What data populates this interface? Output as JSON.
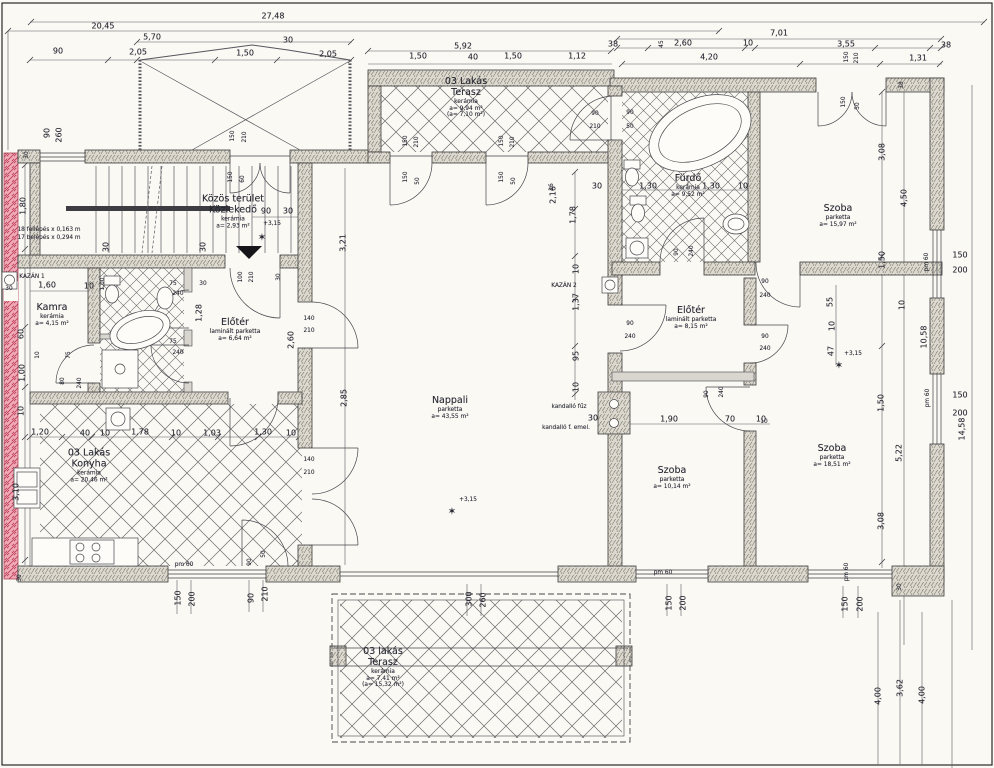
{
  "drawing": {
    "language": "Hungarian",
    "kind": "scanned floor plan",
    "level_mark": "+3,15"
  },
  "rooms": [
    {
      "id": "kozlekedo",
      "x": 233,
      "y": 212,
      "name": [
        "Közös terület",
        "Közlekedő"
      ],
      "sub": [
        "kerámia",
        "a= 2,93 m²"
      ]
    },
    {
      "id": "kamra",
      "x": 52,
      "y": 315,
      "name": [
        "Kamra"
      ],
      "sub": [
        "kerámia",
        "a= 4,15 m²"
      ]
    },
    {
      "id": "eloter-1",
      "x": 235,
      "y": 330,
      "name": [
        "Előtér"
      ],
      "sub": [
        "laminált parketta",
        "a= 6,64 m²"
      ]
    },
    {
      "id": "konyha",
      "x": 89,
      "y": 466,
      "name": [
        "03 Lakás",
        "Konyha"
      ],
      "sub": [
        "kerámia",
        "a= 20,46 m²"
      ]
    },
    {
      "id": "nappali",
      "x": 450,
      "y": 408,
      "name": [
        "Nappali"
      ],
      "sub": [
        "parketta",
        "a= 43,55 m²"
      ]
    },
    {
      "id": "terasz-felso",
      "x": 466,
      "y": 98,
      "name": [
        "03 Lakás",
        "Terasz"
      ],
      "sub": [
        "kerámia",
        "a= 9,94 m²",
        "(a= 7,10 m²)"
      ]
    },
    {
      "id": "furdo",
      "x": 688,
      "y": 186,
      "name": [
        "Fürdő"
      ],
      "sub": [
        "kerámia",
        "a= 9,52 m²"
      ]
    },
    {
      "id": "szoba-1",
      "x": 838,
      "y": 216,
      "name": [
        "Szoba"
      ],
      "sub": [
        "parketta",
        "a= 15,97 m²"
      ]
    },
    {
      "id": "eloter-2",
      "x": 691,
      "y": 318,
      "name": [
        "Előtér"
      ],
      "sub": [
        "laminált parketta",
        "a= 8,15 m²"
      ]
    },
    {
      "id": "szoba-2",
      "x": 672,
      "y": 478,
      "name": [
        "Szoba"
      ],
      "sub": [
        "parketta",
        "a= 10,14 m²"
      ]
    },
    {
      "id": "szoba-3",
      "x": 832,
      "y": 456,
      "name": [
        "Szoba"
      ],
      "sub": [
        "parketta",
        "a= 18,51 m²"
      ]
    },
    {
      "id": "terasz-also",
      "x": 383,
      "y": 668,
      "name": [
        "03 lakás",
        "Terasz"
      ],
      "sub": [
        "kerámia",
        "a= 7,41 m²",
        "(a= 15,32 m²)"
      ]
    }
  ],
  "labels": [
    {
      "t": "27,48",
      "x": 273,
      "y": 16
    },
    {
      "t": "20,45",
      "x": 103,
      "y": 26
    },
    {
      "t": "5,70",
      "x": 152,
      "y": 37
    },
    {
      "t": "2,05",
      "x": 138,
      "y": 52
    },
    {
      "t": "1,50",
      "x": 245,
      "y": 53
    },
    {
      "t": "30",
      "x": 288,
      "y": 40
    },
    {
      "t": "2,05",
      "x": 328,
      "y": 54
    },
    {
      "t": "90",
      "x": 58,
      "y": 51
    },
    {
      "t": "5,92",
      "x": 463,
      "y": 46
    },
    {
      "t": "1,50",
      "x": 418,
      "y": 56
    },
    {
      "t": "40",
      "x": 473,
      "y": 57
    },
    {
      "t": "1,50",
      "x": 513,
      "y": 56
    },
    {
      "t": "1,12",
      "x": 577,
      "y": 56
    },
    {
      "t": "7,01",
      "x": 779,
      "y": 33
    },
    {
      "t": "38",
      "x": 613,
      "y": 44
    },
    {
      "t": "45",
      "x": 662,
      "y": 44,
      "r": 1,
      "s": 2
    },
    {
      "t": "2,60",
      "x": 683,
      "y": 43
    },
    {
      "t": "10",
      "x": 748,
      "y": 43
    },
    {
      "t": "3,55",
      "x": 846,
      "y": 44
    },
    {
      "t": "38",
      "x": 946,
      "y": 45
    },
    {
      "t": "4,20",
      "x": 709,
      "y": 57
    },
    {
      "t": "150",
      "x": 847,
      "y": 57,
      "r": 1,
      "s": 2
    },
    {
      "t": "210",
      "x": 857,
      "y": 58,
      "r": 1,
      "s": 2
    },
    {
      "t": "1,31",
      "x": 918,
      "y": 58
    },
    {
      "t": "90",
      "x": 47,
      "y": 133,
      "r": 1
    },
    {
      "t": "260",
      "x": 59,
      "y": 135,
      "r": 1
    },
    {
      "t": "30",
      "x": 27,
      "y": 155,
      "r": 1,
      "s": 2
    },
    {
      "t": "150",
      "x": 233,
      "y": 136,
      "r": 1,
      "s": 2
    },
    {
      "t": "210",
      "x": 245,
      "y": 137,
      "r": 1,
      "s": 2
    },
    {
      "t": "1,80",
      "x": 23,
      "y": 206,
      "r": 1
    },
    {
      "t": "150",
      "x": 231,
      "y": 177,
      "r": 1,
      "s": 2
    },
    {
      "t": "60",
      "x": 243,
      "y": 179,
      "r": 1,
      "s": 2
    },
    {
      "t": "90",
      "x": 266,
      "y": 211
    },
    {
      "t": "30",
      "x": 288,
      "y": 211
    },
    {
      "t": "+3,15",
      "x": 272,
      "y": 224,
      "s": 2
    },
    {
      "t": "✶",
      "x": 262,
      "y": 238,
      "s": 6,
      "n": "level-marker-icon"
    },
    {
      "t": "3,21",
      "x": 343,
      "y": 243,
      "r": 1
    },
    {
      "t": "30",
      "x": 106,
      "y": 247,
      "r": 1
    },
    {
      "t": "30",
      "x": 203,
      "y": 247,
      "r": 1
    },
    {
      "t": "KAZÁN 1",
      "x": 32,
      "y": 277,
      "s": 2
    },
    {
      "t": "30",
      "x": 9,
      "y": 289,
      "s": 2
    },
    {
      "t": "1,60",
      "x": 47,
      "y": 285
    },
    {
      "t": "10",
      "x": 89,
      "y": 286
    },
    {
      "t": "100",
      "x": 241,
      "y": 277,
      "r": 1,
      "s": 2
    },
    {
      "t": "210",
      "x": 252,
      "y": 277,
      "r": 1,
      "s": 2
    },
    {
      "t": "30",
      "x": 279,
      "y": 277,
      "r": 1,
      "s": 2
    },
    {
      "t": "75",
      "x": 173,
      "y": 284,
      "s": 2
    },
    {
      "t": "240",
      "x": 178,
      "y": 294,
      "s": 2
    },
    {
      "t": "30",
      "x": 203,
      "y": 284,
      "s": 2
    },
    {
      "t": "1,00",
      "x": 103,
      "y": 284,
      "r": 1,
      "s": 2
    },
    {
      "t": "1,28",
      "x": 199,
      "y": 313,
      "r": 1
    },
    {
      "t": "60",
      "x": 21,
      "y": 334,
      "r": 1
    },
    {
      "t": "75",
      "x": 69,
      "y": 355,
      "r": 1,
      "s": 2
    },
    {
      "t": "10",
      "x": 38,
      "y": 355,
      "r": 1,
      "s": 2
    },
    {
      "t": "1,00",
      "x": 22,
      "y": 373,
      "r": 1
    },
    {
      "t": "80",
      "x": 63,
      "y": 381,
      "r": 1,
      "s": 2
    },
    {
      "t": "240",
      "x": 80,
      "y": 383,
      "r": 1,
      "s": 2
    },
    {
      "t": "75",
      "x": 173,
      "y": 342,
      "s": 2
    },
    {
      "t": "240",
      "x": 178,
      "y": 353,
      "s": 2
    },
    {
      "t": "10",
      "x": 21,
      "y": 411,
      "r": 1
    },
    {
      "t": "140",
      "x": 309,
      "y": 319,
      "s": 2
    },
    {
      "t": "210",
      "x": 309,
      "y": 331,
      "s": 2
    },
    {
      "t": "2,60",
      "x": 291,
      "y": 340,
      "r": 1
    },
    {
      "t": "2,85",
      "x": 344,
      "y": 398,
      "r": 1
    },
    {
      "t": "140",
      "x": 309,
      "y": 460,
      "s": 2
    },
    {
      "t": "210",
      "x": 309,
      "y": 473,
      "s": 2
    },
    {
      "t": "1,20",
      "x": 40,
      "y": 432
    },
    {
      "t": "40",
      "x": 85,
      "y": 433
    },
    {
      "t": "10",
      "x": 105,
      "y": 433
    },
    {
      "t": "1,78",
      "x": 140,
      "y": 432
    },
    {
      "t": "10",
      "x": 176,
      "y": 433
    },
    {
      "t": "1,03",
      "x": 212,
      "y": 433
    },
    {
      "t": "1,30",
      "x": 263,
      "y": 432
    },
    {
      "t": "10",
      "x": 291,
      "y": 433
    },
    {
      "t": "3,10",
      "x": 16,
      "y": 492,
      "r": 1
    },
    {
      "t": "30",
      "x": 20,
      "y": 578,
      "r": 1,
      "s": 2
    },
    {
      "t": "pm 60",
      "x": 184,
      "y": 565,
      "s": 2
    },
    {
      "t": "150",
      "x": 178,
      "y": 598,
      "r": 1
    },
    {
      "t": "200",
      "x": 192,
      "y": 599,
      "r": 1
    },
    {
      "t": "90",
      "x": 250,
      "y": 562,
      "r": 1,
      "s": 2
    },
    {
      "t": "50",
      "x": 264,
      "y": 554,
      "r": 1,
      "s": 2
    },
    {
      "t": "90",
      "x": 251,
      "y": 598,
      "r": 1
    },
    {
      "t": "210",
      "x": 265,
      "y": 594,
      "r": 1
    },
    {
      "t": "150",
      "x": 406,
      "y": 141,
      "r": 1,
      "s": 2
    },
    {
      "t": "210",
      "x": 417,
      "y": 142,
      "r": 1,
      "s": 2
    },
    {
      "t": "150",
      "x": 502,
      "y": 141,
      "r": 1,
      "s": 2
    },
    {
      "t": "210",
      "x": 513,
      "y": 142,
      "r": 1,
      "s": 2
    },
    {
      "t": "150",
      "x": 406,
      "y": 177,
      "r": 1,
      "s": 2
    },
    {
      "t": "50",
      "x": 418,
      "y": 181,
      "r": 1,
      "s": 2
    },
    {
      "t": "150",
      "x": 502,
      "y": 177,
      "r": 1,
      "s": 2
    },
    {
      "t": "50",
      "x": 514,
      "y": 181,
      "r": 1,
      "s": 2
    },
    {
      "t": "90",
      "x": 595,
      "y": 114,
      "s": 2
    },
    {
      "t": "210",
      "x": 595,
      "y": 127,
      "s": 2
    },
    {
      "t": "16",
      "x": 552,
      "y": 187,
      "r": 1,
      "s": 2
    },
    {
      "t": "30",
      "x": 597,
      "y": 186
    },
    {
      "t": "2,16",
      "x": 553,
      "y": 195,
      "r": 1
    },
    {
      "t": "1,78",
      "x": 573,
      "y": 215,
      "r": 1
    },
    {
      "t": "10",
      "x": 576,
      "y": 269,
      "r": 1
    },
    {
      "t": "KAZÁN 2",
      "x": 564,
      "y": 286,
      "s": 2
    },
    {
      "t": "1,37",
      "x": 576,
      "y": 302,
      "r": 1
    },
    {
      "t": "95",
      "x": 576,
      "y": 356,
      "r": 1
    },
    {
      "t": "10",
      "x": 576,
      "y": 387,
      "r": 1
    },
    {
      "t": "90",
      "x": 630,
      "y": 324,
      "s": 2
    },
    {
      "t": "240",
      "x": 630,
      "y": 337,
      "s": 2
    },
    {
      "t": "kandalló fűz",
      "x": 569,
      "y": 407,
      "s": 2
    },
    {
      "t": "30",
      "x": 593,
      "y": 418
    },
    {
      "t": "kandalló f. emel.",
      "x": 566,
      "y": 428,
      "s": 2
    },
    {
      "t": "+3,15",
      "x": 468,
      "y": 500,
      "s": 2
    },
    {
      "t": "✶",
      "x": 452,
      "y": 512,
      "s": 6,
      "n": "level-marker-icon"
    },
    {
      "t": "90",
      "x": 630,
      "y": 113,
      "s": 2
    },
    {
      "t": "50",
      "x": 630,
      "y": 127,
      "s": 2
    },
    {
      "t": "1,30",
      "x": 648,
      "y": 186
    },
    {
      "t": "1,30",
      "x": 711,
      "y": 186
    },
    {
      "t": "10",
      "x": 743,
      "y": 186
    },
    {
      "t": "90",
      "x": 677,
      "y": 252,
      "r": 1,
      "s": 2
    },
    {
      "t": "240",
      "x": 692,
      "y": 251,
      "r": 1,
      "s": 2
    },
    {
      "t": "150",
      "x": 844,
      "y": 102,
      "r": 1,
      "s": 2
    },
    {
      "t": "50",
      "x": 858,
      "y": 106,
      "r": 1,
      "s": 2
    },
    {
      "t": "38",
      "x": 902,
      "y": 85,
      "r": 1,
      "s": 2
    },
    {
      "t": "3,08",
      "x": 882,
      "y": 152,
      "r": 1
    },
    {
      "t": "4,50",
      "x": 904,
      "y": 198,
      "r": 1
    },
    {
      "t": "1,50",
      "x": 882,
      "y": 260,
      "r": 1
    },
    {
      "t": "90",
      "x": 765,
      "y": 282,
      "s": 2
    },
    {
      "t": "240",
      "x": 765,
      "y": 296,
      "s": 2
    },
    {
      "t": "90",
      "x": 765,
      "y": 337,
      "s": 2
    },
    {
      "t": "240",
      "x": 765,
      "y": 349,
      "s": 2
    },
    {
      "t": "55",
      "x": 830,
      "y": 302,
      "r": 1
    },
    {
      "t": "10",
      "x": 832,
      "y": 326,
      "r": 1
    },
    {
      "t": "47",
      "x": 831,
      "y": 351,
      "r": 1
    },
    {
      "t": "+3,15",
      "x": 853,
      "y": 354,
      "s": 2
    },
    {
      "t": "✶",
      "x": 839,
      "y": 366,
      "s": 6,
      "n": "level-marker-icon"
    },
    {
      "t": "pm 60",
      "x": 927,
      "y": 262,
      "r": 1,
      "s": 2
    },
    {
      "t": "150",
      "x": 960,
      "y": 255
    },
    {
      "t": "200",
      "x": 960,
      "y": 270
    },
    {
      "t": "10",
      "x": 902,
      "y": 305,
      "r": 1
    },
    {
      "t": "10,58",
      "x": 924,
      "y": 337,
      "r": 1
    },
    {
      "t": "pm 60",
      "x": 928,
      "y": 398,
      "r": 1,
      "s": 2
    },
    {
      "t": "150",
      "x": 960,
      "y": 395
    },
    {
      "t": "200",
      "x": 960,
      "y": 413
    },
    {
      "t": "14,58",
      "x": 962,
      "y": 429,
      "r": 1
    },
    {
      "t": "1,50",
      "x": 881,
      "y": 403,
      "r": 1
    },
    {
      "t": "5,22",
      "x": 899,
      "y": 453,
      "r": 1
    },
    {
      "t": "3,08",
      "x": 881,
      "y": 521,
      "r": 1
    },
    {
      "t": "1,90",
      "x": 669,
      "y": 419
    },
    {
      "t": "70",
      "x": 730,
      "y": 419
    },
    {
      "t": "10",
      "x": 761,
      "y": 419
    },
    {
      "t": "90",
      "x": 707,
      "y": 394,
      "r": 1,
      "s": 2
    },
    {
      "t": "240",
      "x": 722,
      "y": 392,
      "r": 1,
      "s": 2
    },
    {
      "t": "10",
      "x": 764,
      "y": 422,
      "s": 2
    },
    {
      "t": "pm 60",
      "x": 663,
      "y": 573,
      "s": 2
    },
    {
      "t": "150",
      "x": 669,
      "y": 603,
      "r": 1
    },
    {
      "t": "200",
      "x": 683,
      "y": 603,
      "r": 1
    },
    {
      "t": "300",
      "x": 469,
      "y": 599,
      "r": 1
    },
    {
      "t": "260",
      "x": 483,
      "y": 600,
      "r": 1
    },
    {
      "t": "pm 60",
      "x": 847,
      "y": 572,
      "r": 1,
      "s": 2
    },
    {
      "t": "150",
      "x": 845,
      "y": 604,
      "r": 1
    },
    {
      "t": "200",
      "x": 860,
      "y": 604,
      "r": 1
    },
    {
      "t": "30",
      "x": 900,
      "y": 587,
      "r": 1,
      "s": 2
    },
    {
      "t": "4,00",
      "x": 878,
      "y": 696,
      "r": 1
    },
    {
      "t": "3,62",
      "x": 900,
      "y": 688,
      "r": 1
    },
    {
      "t": "4,00",
      "x": 922,
      "y": 695,
      "r": 1
    },
    {
      "t": "18 fellépés x 0,163 m",
      "x": 49,
      "y": 230,
      "s": 2
    },
    {
      "t": "17 belépés x 0,294 m",
      "x": 49,
      "y": 238,
      "s": 2
    }
  ]
}
